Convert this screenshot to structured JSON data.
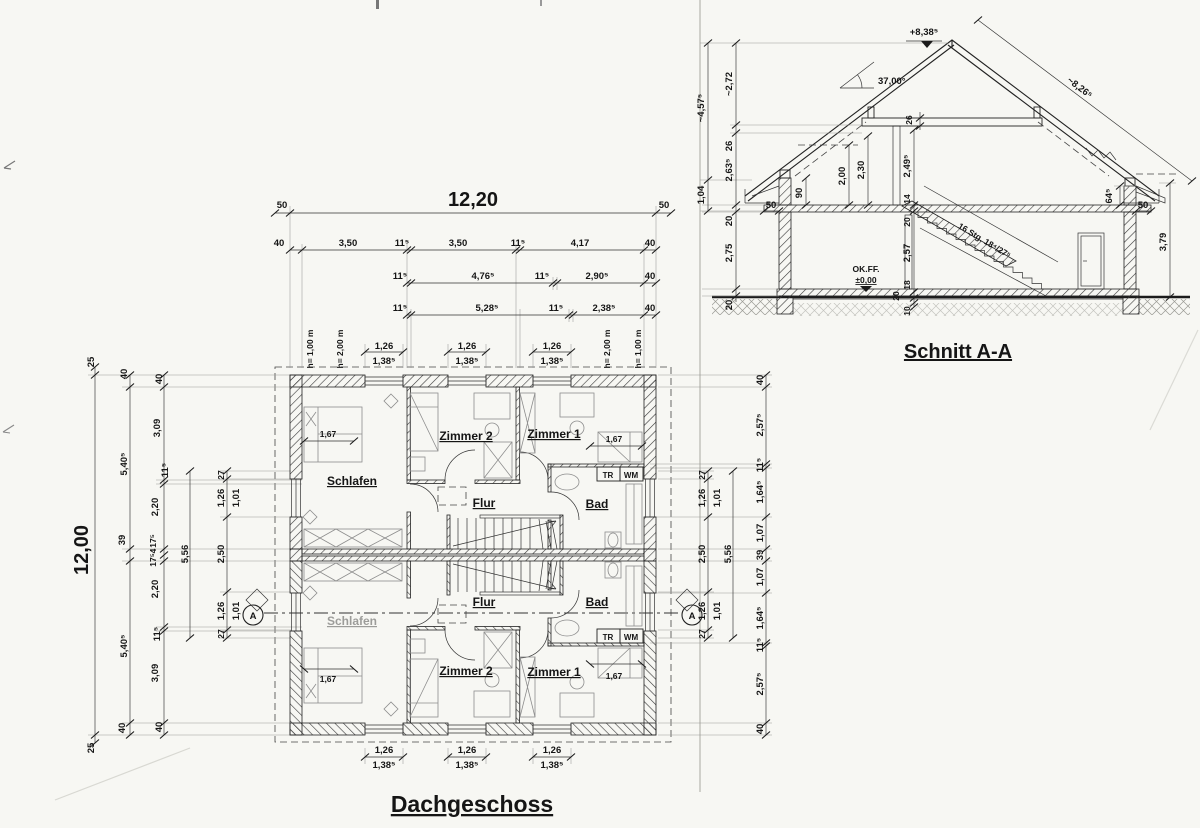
{
  "plan": {
    "title": "Dachgeschoss",
    "top": {
      "overall": "12,20",
      "eave": "50",
      "chain1": [
        "40",
        "3,50",
        "11⁵",
        "3,50",
        "11⁵",
        "4,17",
        "40"
      ],
      "chain2": [
        "11⁵",
        "4,76⁵",
        "11⁵",
        "2,90⁵",
        "40"
      ],
      "chain3": [
        "11⁵",
        "5,28⁵",
        "11⁵",
        "2,38⁵",
        "40"
      ],
      "win_w": "1,26",
      "win_sill": "1,38⁵",
      "h100": "h= 1,00 m",
      "h200": "h= 2,00 m"
    },
    "left": {
      "overall": "12,00",
      "eave": "25",
      "chain2": [
        "40",
        "5,40⁵",
        "39",
        "5,40⁵",
        "40"
      ],
      "chain3": [
        "40",
        "3,09",
        "11⁵",
        "2,20",
        "17⁵",
        "4",
        "17⁵",
        "2,20",
        "11⁵",
        "3,09",
        "40"
      ]
    },
    "right": {
      "chain": [
        "40",
        "2,57⁵",
        "11⁵",
        "1,64⁵",
        "1,07",
        "39",
        "1,07",
        "1,64⁵",
        "11⁵",
        "2,57⁵",
        "40"
      ]
    },
    "win": {
      "edge": "27",
      "width": "1,26",
      "sill": "1,01",
      "mid": "2,50",
      "span": "5,56"
    },
    "rooms": {
      "schlafen": "Schlafen",
      "zimmer2": "Zimmer 2",
      "zimmer1": "Zimmer 1",
      "flur": "Flur",
      "bad": "Bad",
      "tr": "TR",
      "wm": "WM",
      "bed_dim": "1,67"
    },
    "marker": "A"
  },
  "section": {
    "title": "Schnitt A-A",
    "ridge_level": "+8,38⁵",
    "roof_angle": "37,00°",
    "slope_length": "~8,26⁵",
    "left_outer": [
      "~4,57⁵",
      "1,04"
    ],
    "left_inner": [
      "~2,72",
      "26",
      "2,63⁵",
      "20",
      "2,75",
      "20"
    ],
    "collar": "26",
    "knee_left": "90",
    "h200": "2,00",
    "h230": "2,30",
    "h249": "2,49⁵",
    "d14": "14",
    "d20": "20",
    "eg_height": "2,57",
    "d18": "18",
    "d10": "10",
    "eave": "50",
    "knee_right": "64⁵",
    "right_height": "3,79",
    "floor_label": "OK.FF.",
    "floor_level": "±0,00",
    "stair": "16 Stg. 18⁴/27⁵"
  }
}
